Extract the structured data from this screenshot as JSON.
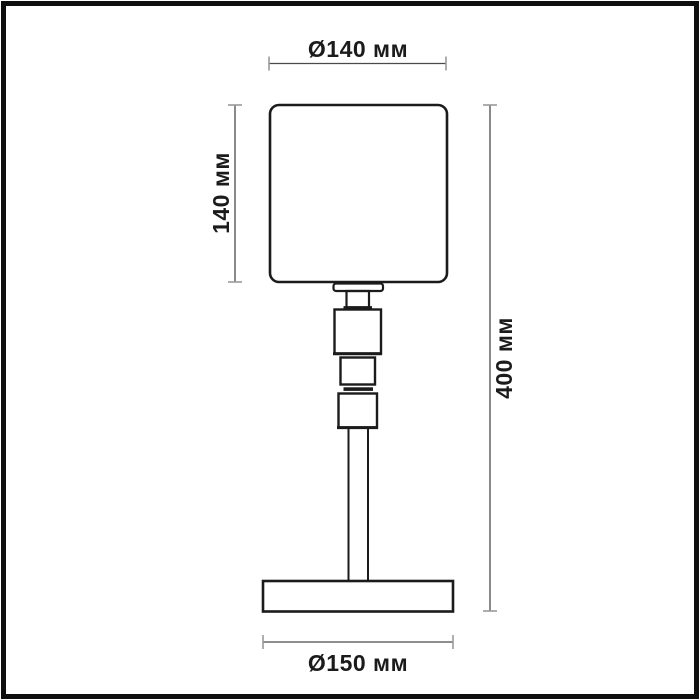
{
  "diagram": {
    "title": "table-lamp-dimension-drawing",
    "dimensions": {
      "shade_diameter": "Ø140 мм",
      "shade_height": "140 мм",
      "total_height": "400 мм",
      "base_diameter": "Ø150 мм"
    },
    "colors": {
      "outline": "#1b1b1b",
      "dimension_line": "#4a4a4a",
      "tick": "#9a9a9a",
      "background": "#ffffff",
      "frame": "#0f0f0f"
    }
  }
}
